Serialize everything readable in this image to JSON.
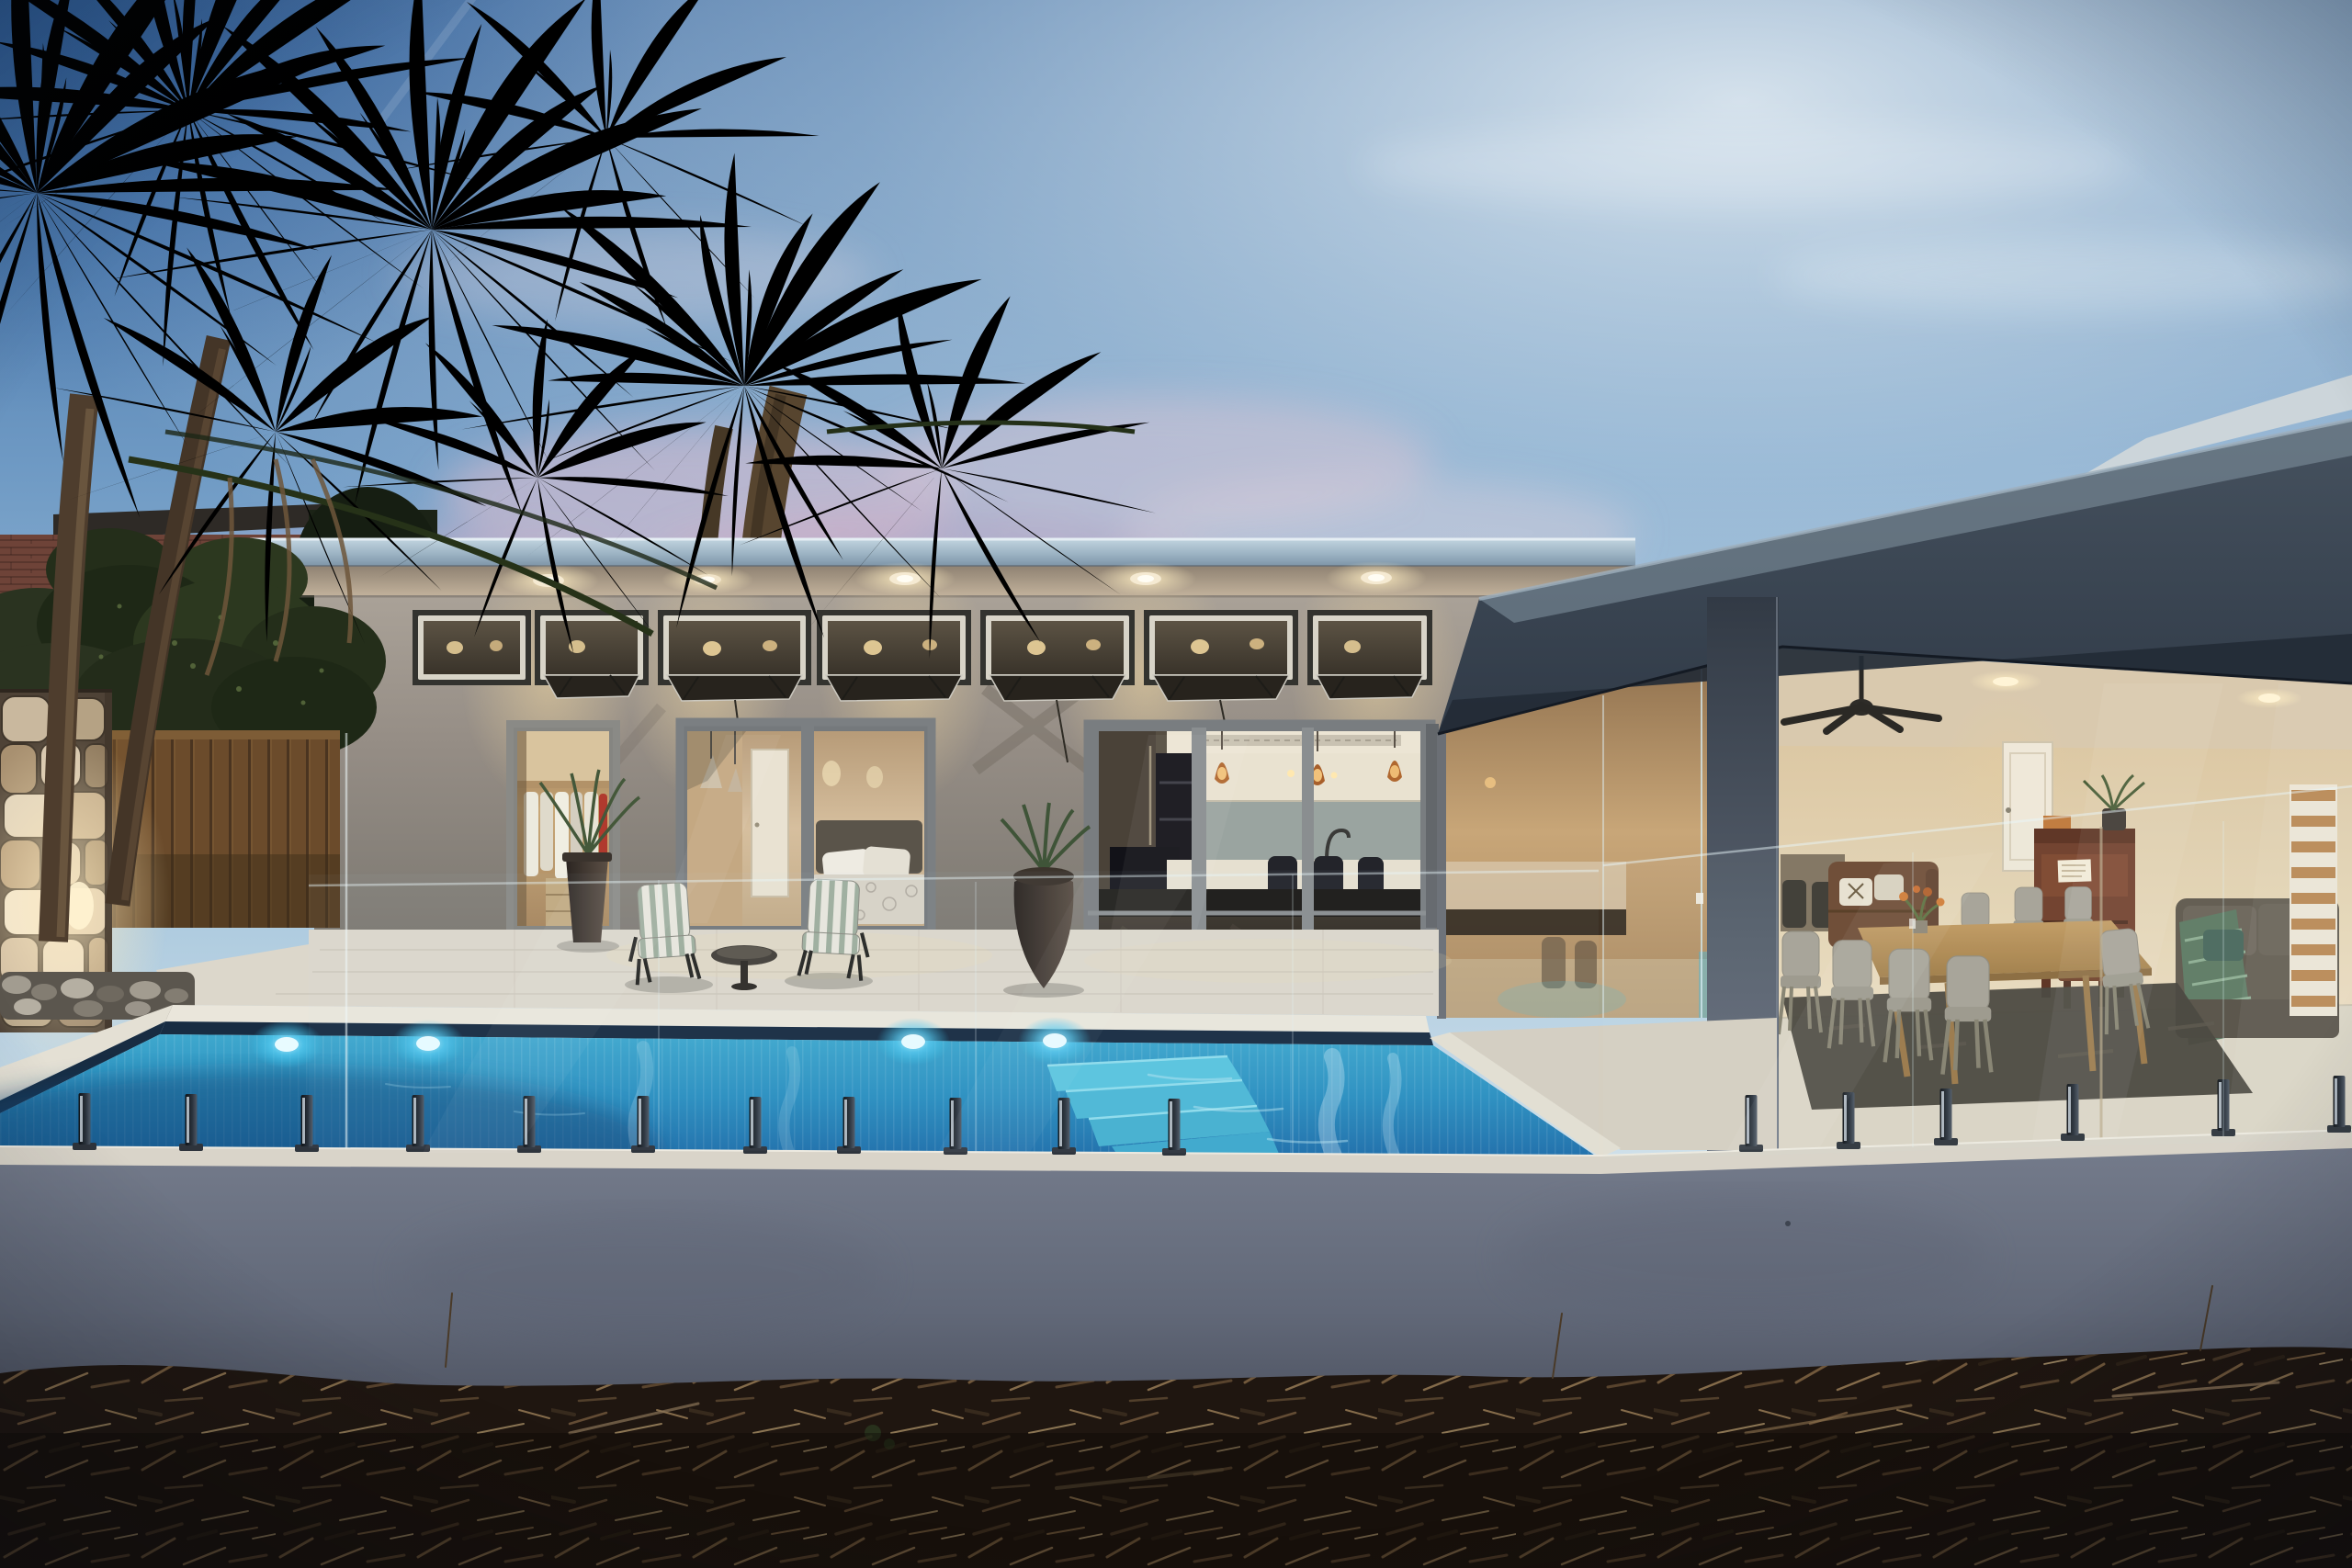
{
  "scene": {
    "description": "Dusk photograph of a modern single-storey rendered home with a glowing azure swimming pool behind a frameless glass pool fence, palm trees and a brick neighbouring house to the left, warm interior lighting throughout, and dark garden mulch in the foreground.",
    "time_of_day": "dusk",
    "setting": "residential backyard",
    "weather": "clear with pink clouds"
  },
  "palette": {
    "sky_top": "#38679f",
    "sky_mid": "#a6c6dd",
    "sky_horizon": "#d5e2ea",
    "cloud_pink": "#e0aec6",
    "palm_foliage": "#1f2b19",
    "palm_foliage_light": "#3a4c2e",
    "palm_trunk": "#4e3d2d",
    "brick_wall": "#6e4338",
    "brick_roof": "#2e2a26",
    "awning_red": "#8e3340",
    "hedge_green": "#2a3320",
    "timber_fence": "#6b4b2b",
    "stone_mortar": "#4e4236",
    "fascia_metal": "#a9bfce",
    "soffit_lit": "#b3a591",
    "wall_render": "#98908a",
    "clerestory_glass": "#4f4638",
    "downlight_warm": "#ffe9b8",
    "counter_black": "#1c1a16",
    "dark_wing": "#3a4450",
    "dark_band": "#232b36",
    "column_grey": "#596170",
    "alfresco_wall": "#e6d7bb",
    "sofa_brown": "#6b4730",
    "piano_brown": "#6e3b27",
    "chair_grey": "#a6a296",
    "table_wood": "#b48c58",
    "rug_dark": "#46423a",
    "throw_green": "#5d7a62",
    "patio_paver": "#dcd7cb",
    "coping_white": "#eae6db",
    "waterline_navy": "#182c42",
    "water_top": "#3fa8cd",
    "water_deep": "#1d6ca8",
    "steps_aqua": "#59c4de",
    "pool_light_glow": "#35c0ea",
    "front_wall": "#6a7080",
    "wall_cap": "#d9d4c9",
    "spigot_dark": "#14181e",
    "mulch_dark": "#1f1610",
    "pebble_base": "#5b564e",
    "glass_edge": "#e8f6fa"
  },
  "vegetation": {
    "palm_crowns": 8,
    "palm_trunks": 4,
    "hedge": "dark clipped shrubs along boundary",
    "mulch": "wood-chip garden bed foreground"
  },
  "neighbour_house": {
    "type": "two-storey brick house",
    "window": "roller-shutter window",
    "awning": "red metal awning"
  },
  "main_house": {
    "left_wing": {
      "downlights": 5,
      "clerestory_windows": 7,
      "open_awning_sashes": 6,
      "rooms_visible": [
        "walk-in wardrobe",
        "bedroom",
        "kitchen"
      ],
      "kitchen_pendants": 3,
      "bedroom_pendants": 2
    },
    "right_wing": {
      "finish": "dark rendered parapet wing",
      "ceiling_fans": 1,
      "rooms_visible": [
        "dining room",
        "living room"
      ],
      "furniture": [
        "timber dining table",
        "grey dining chairs",
        "leather sofa",
        "upright piano",
        "piano stool",
        "sofa with green throw",
        "timber slat feature wall"
      ]
    }
  },
  "pool": {
    "finish": "azure mosaic tile",
    "underwater_lights": 4,
    "steps": 4,
    "coping": "white stone coping"
  },
  "fence": {
    "type": "frameless glass pool fence",
    "spigots": 17,
    "safety_stickers": 3
  },
  "patio": {
    "furniture": [
      "two striped lounge chairs",
      "round side table",
      "two dark planters"
    ],
    "stone_pillar": "feature stone pillar with uplight"
  }
}
